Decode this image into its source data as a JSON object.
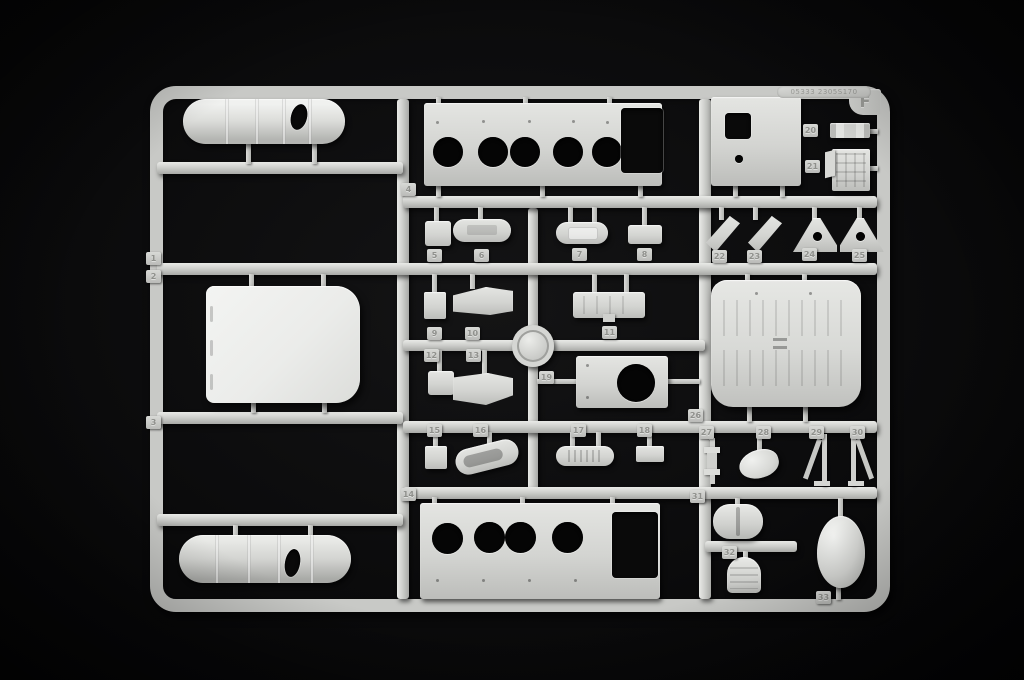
{
  "sprue": {
    "letter": "F",
    "mold_text": "05333 2305S170",
    "colors": {
      "plastic": "#cfd0cd",
      "plastic_light": "#eceded",
      "background": "#0b0b0c"
    },
    "tags": {
      "t1": "1",
      "t2": "2",
      "t3": "3",
      "t4": "4",
      "t5": "5",
      "t6": "6",
      "t7": "7",
      "t8": "8",
      "t9": "9",
      "t10": "10",
      "t11": "11",
      "t12": "12",
      "t13": "13",
      "t14": "14",
      "t15": "15",
      "t16": "16",
      "t17": "17",
      "t18": "18",
      "t19": "19",
      "t20": "20",
      "t21": "21",
      "t22": "22",
      "t23": "23",
      "t24": "24",
      "t25": "25",
      "t26": "26",
      "t27": "27",
      "t28": "28",
      "t29": "29",
      "t30": "30",
      "t31": "31",
      "t32": "32",
      "t33": "33"
    }
  }
}
